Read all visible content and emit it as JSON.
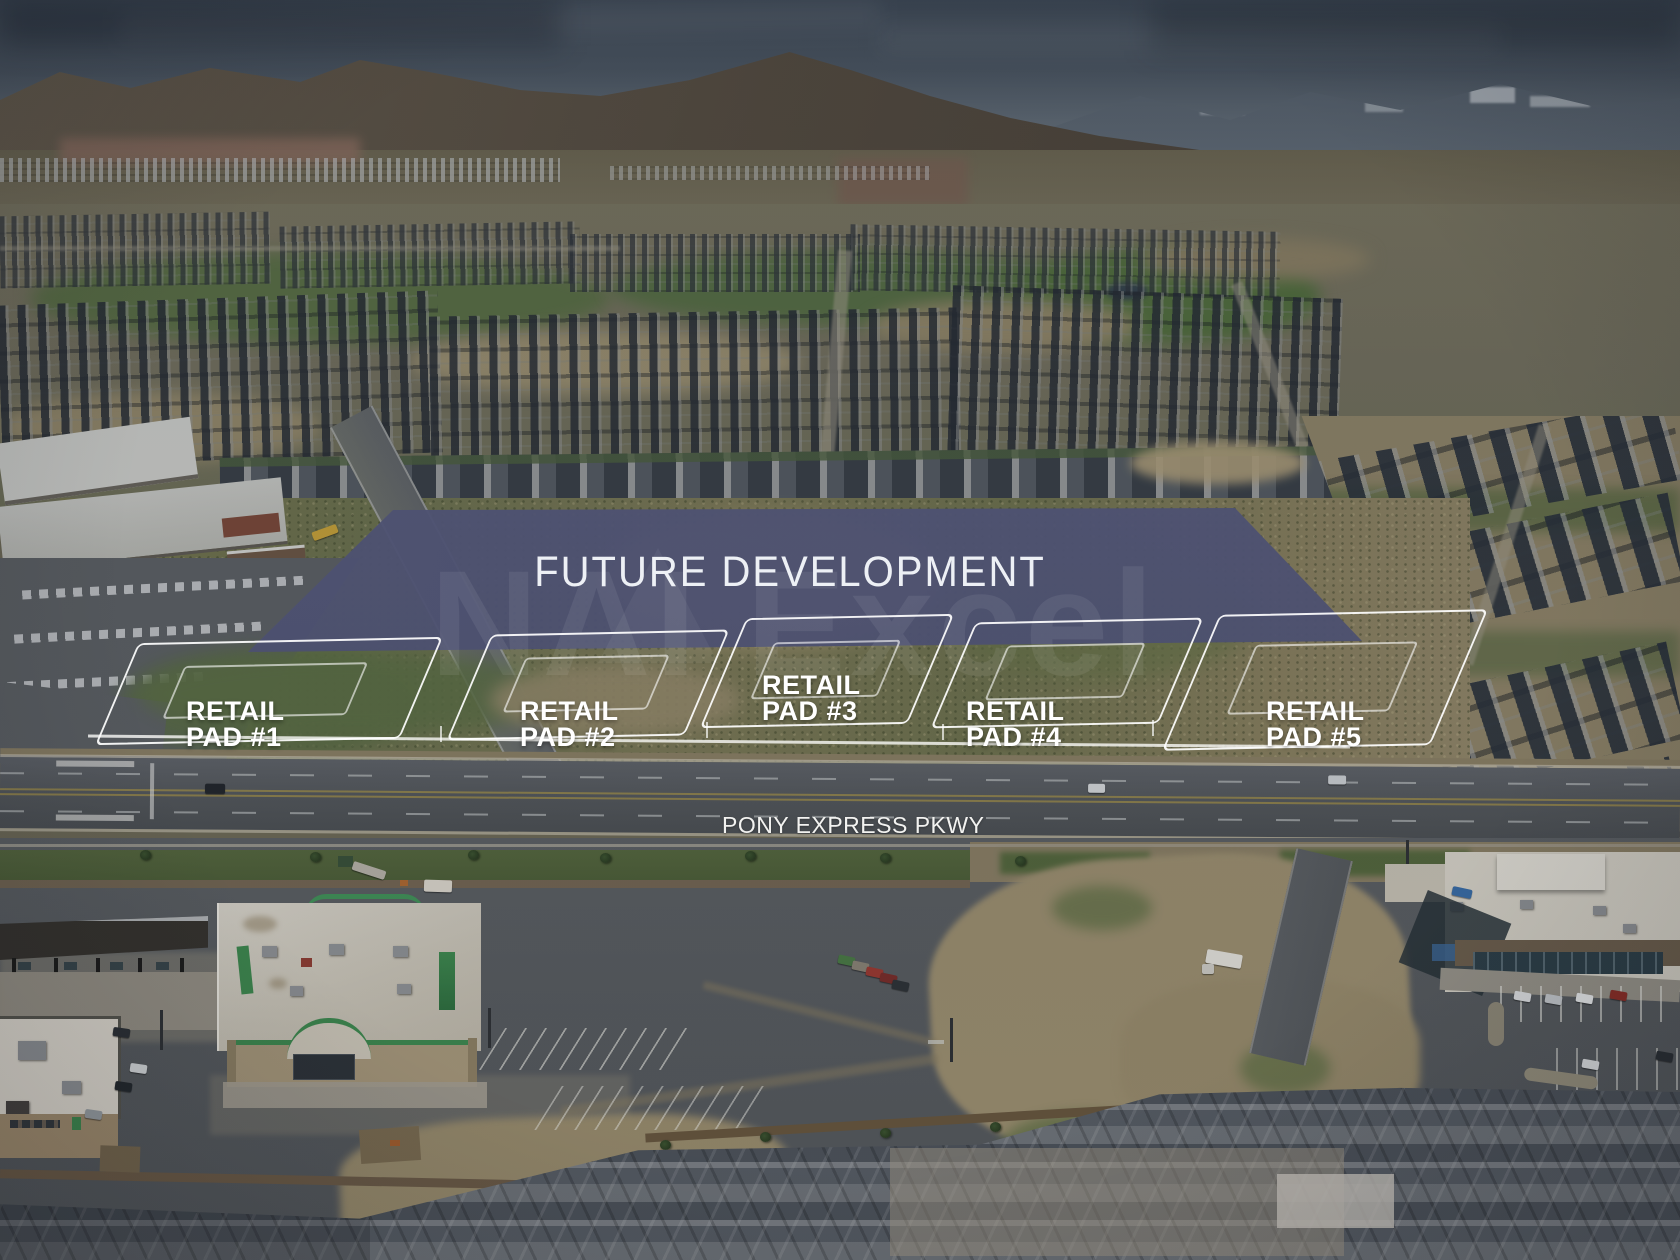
{
  "annotations": {
    "future_development": "FUTURE DEVELOPMENT",
    "road": "PONY EXPRESS PKWY",
    "watermark": "NAI Excel",
    "pads": [
      {
        "line1": "RETAIL",
        "line2": "PAD #1"
      },
      {
        "line1": "RETAIL",
        "line2": "PAD #2"
      },
      {
        "line1": "RETAIL",
        "line2": "PAD #3"
      },
      {
        "line1": "RETAIL",
        "line2": "PAD #4"
      },
      {
        "line1": "RETAIL",
        "line2": "PAD #5"
      }
    ]
  },
  "colors": {
    "overlay_fill": "#4c5070",
    "label_text": "#ffffff",
    "road_label_text": "#f2f2f0",
    "accent_green": "#3f8a50",
    "watermark_white_opacity": "0.07"
  }
}
